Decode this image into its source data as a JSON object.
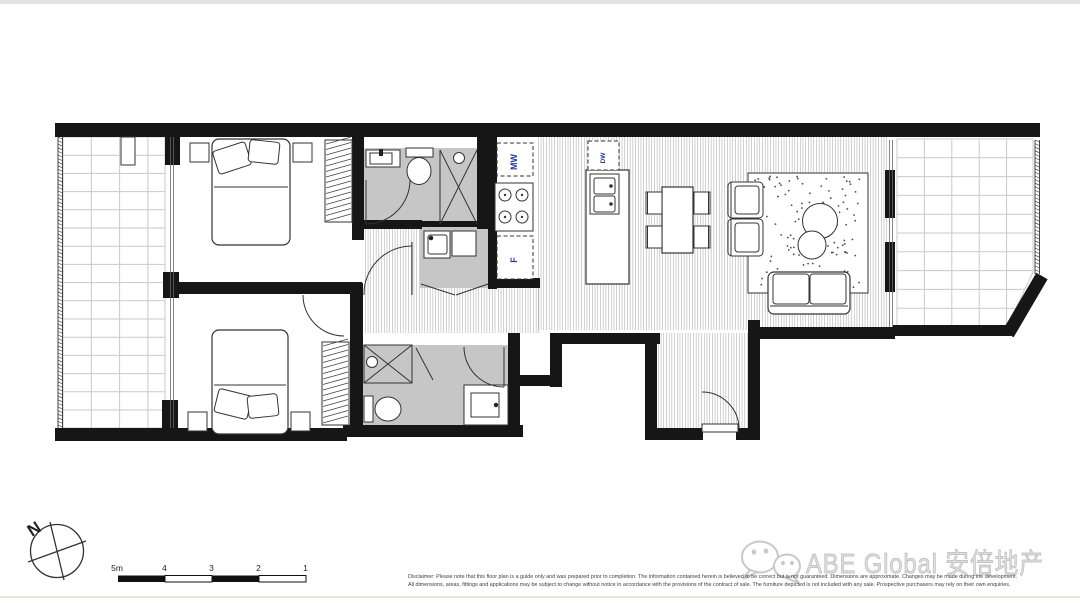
{
  "page": {
    "top_strip_color": "#e2e2e5",
    "footer_line_color": "#eae6d9",
    "background": "#ffffff"
  },
  "plan": {
    "wall_color": "#161616",
    "bathroom_floor_color": "#c6c6c6",
    "floor_stripe_color": "#ababab",
    "tile_line_color": "#c9c9c9",
    "rug_dot_color": "#4a4a4a",
    "label_color": "#2a3f8f",
    "appliances": {
      "microwave": "MW",
      "fridge": "F",
      "dishwasher": "DW"
    }
  },
  "compass": {
    "north_label": "N"
  },
  "scale_bar": {
    "labels": [
      "5m",
      "4",
      "3",
      "2",
      "1"
    ]
  },
  "branding": {
    "icon": "wechat-logo-icon",
    "text": "ABE Global 安倍地产"
  },
  "disclaimer": {
    "line1": "Disclaimer: Please note that this floor plan is a guide only and was prepared prior to completion. The information contained herein is believed to be correct but is not guaranteed. Dimensions are approximate. Changes may be made during the development.",
    "line2": "All dimensions, areas, fittings and applications may be subject to change without notice in accordance with the provisions of the contract of sale. The furniture depicted is not included with any sale. Prospective purchasers may rely on their own enquiries."
  }
}
